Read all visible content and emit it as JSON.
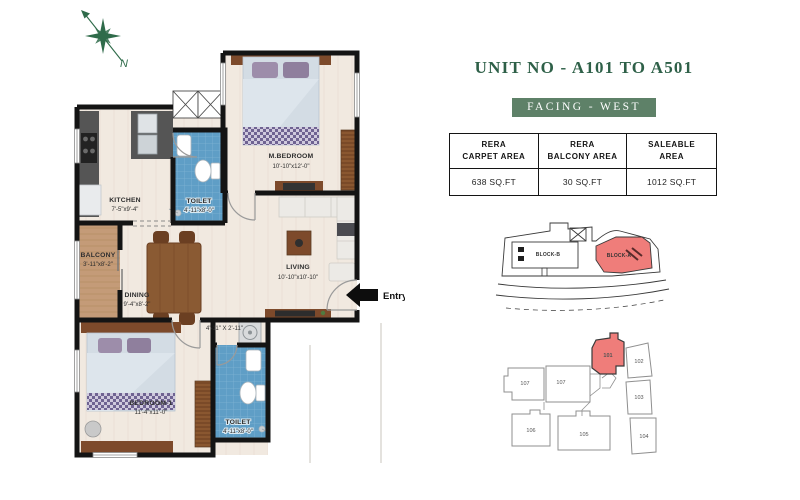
{
  "compass": {
    "north_label": "N"
  },
  "header": {
    "title": "UNIT NO - A101 TO A501",
    "facing_badge": "FACING - WEST"
  },
  "area_table": {
    "columns": [
      {
        "header_line1": "RERA",
        "header_line2": "CARPET AREA",
        "value": "638 SQ.FT"
      },
      {
        "header_line1": "RERA",
        "header_line2": "BALCONY AREA",
        "value": "30 SQ.FT"
      },
      {
        "header_line1": "SALEABLE",
        "header_line2": "AREA",
        "value": "1012 SQ.FT"
      }
    ]
  },
  "floor_plan": {
    "entry_label": "Entry",
    "rooms": [
      {
        "name": "KITCHEN",
        "dims": "7'-5\"x9'-4\""
      },
      {
        "name": "TOILET",
        "dims": "4'-11\"x8'-0\""
      },
      {
        "name": "M.BEDROOM",
        "dims": "10'-10\"x12'-0\""
      },
      {
        "name": "BALCONY",
        "dims": "3'-11\"x8'-2\""
      },
      {
        "name": "DINING",
        "dims": "9'-4\"x8'-2\""
      },
      {
        "name": "LIVING",
        "dims": "10'-10\"x10'-10\""
      },
      {
        "name": "",
        "dims": "4'-11\" X 2'-11\""
      },
      {
        "name": "BEDROOM-1",
        "dims": "11'-4\"x11'-0\""
      },
      {
        "name": "TOILET",
        "dims": "4'-11\"x8'-0\""
      }
    ]
  },
  "site_map": {
    "blocks": [
      {
        "label": "BLOCK-B",
        "highlighted": false
      },
      {
        "label": "BLOCK-A",
        "highlighted": true
      }
    ]
  },
  "key_plan": {
    "units": [
      {
        "label": "101",
        "highlighted": true
      },
      {
        "label": "102",
        "highlighted": false
      },
      {
        "label": "103",
        "highlighted": false
      },
      {
        "label": "104",
        "highlighted": false
      },
      {
        "label": "105",
        "highlighted": false
      },
      {
        "label": "106",
        "highlighted": false
      },
      {
        "label": "107",
        "highlighted": false
      },
      {
        "label": "107",
        "highlighted": false
      }
    ]
  },
  "colors": {
    "accent_green": "#2e6048",
    "badge_green": "#5e8168",
    "highlight_red": "#ef7d7a",
    "toilet_blue": "#5f9ec6",
    "balcony_tan": "#c49b78"
  }
}
